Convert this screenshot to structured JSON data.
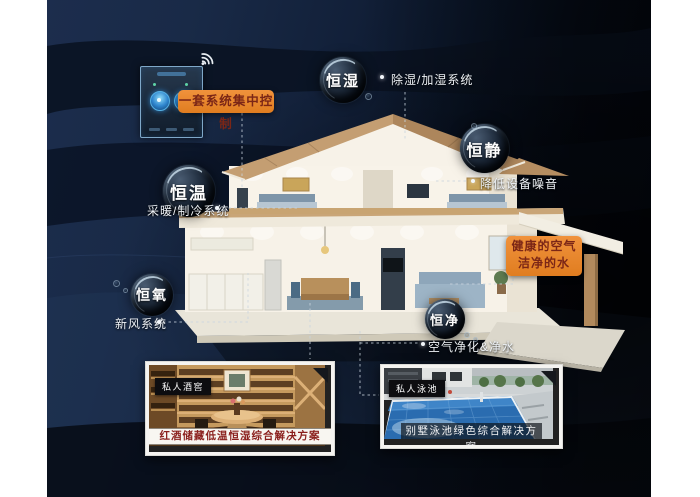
{
  "control": {
    "label": "一套系统集中控制"
  },
  "bubbles": [
    {
      "name": "humidity",
      "label": "恒湿",
      "desc": "除湿/加湿系统"
    },
    {
      "name": "quiet",
      "label": "恒静",
      "desc": "降低设备噪音"
    },
    {
      "name": "temperature",
      "label": "恒温",
      "desc": "采暖/制冷系统"
    },
    {
      "name": "oxygen",
      "label": "恒氧",
      "desc": "新风系统"
    },
    {
      "name": "clean",
      "label": "恒净",
      "desc": "空气净化&净水"
    }
  ],
  "callout": {
    "line1": "健康的空气",
    "line2": "洁净的水"
  },
  "cards": [
    {
      "tag": "私人酒窖",
      "caption": "红酒储藏低温恒湿综合解决方案"
    },
    {
      "tag": "私人泳池",
      "caption": "别墅泳池绿色综合解决方案"
    }
  ],
  "icons": {
    "wifi": "wifi-icon"
  },
  "colors": {
    "accent_orange": "#e8862e",
    "accent_text": "#7b2616",
    "background_navy": "#12203a"
  }
}
